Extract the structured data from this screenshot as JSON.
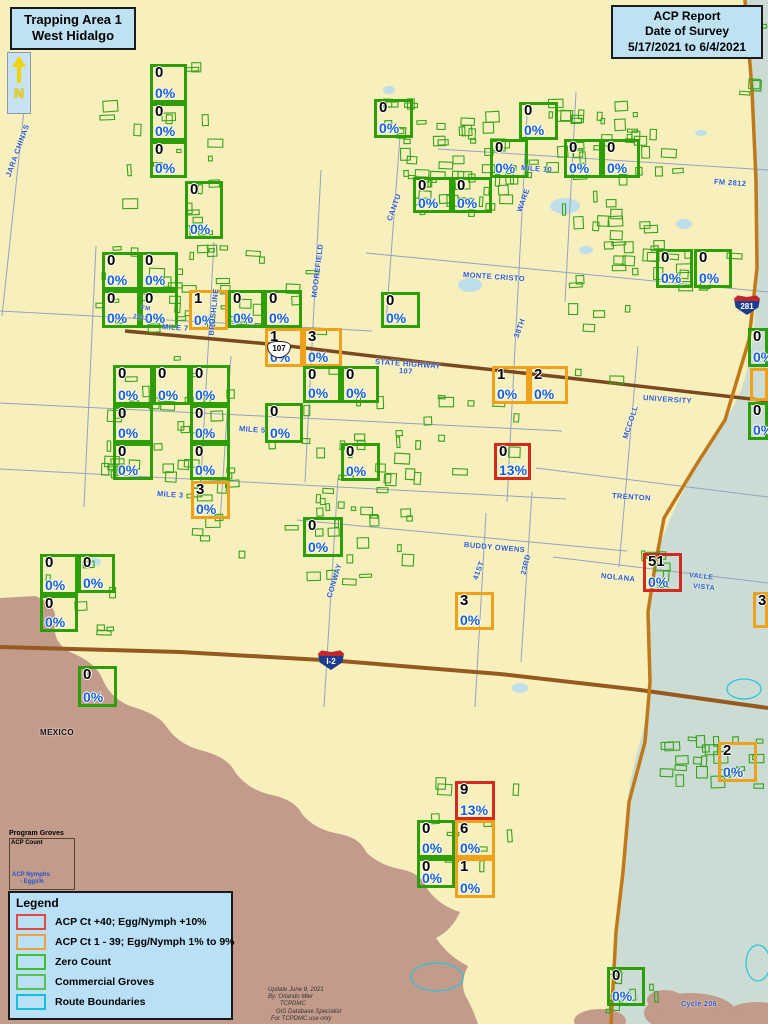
{
  "header": {
    "area_title_line1": "Trapping Area 1",
    "area_title_line2": "West Hidalgo",
    "report_line1": "ACP Report",
    "report_line2": "Date of Survey",
    "report_line3": "5/17/2021  to  6/4/2021",
    "compass_label": "N"
  },
  "legend": {
    "title": "Legend",
    "items": [
      {
        "label": "ACP Ct +40; Egg/Nymph +10%",
        "color": "#E04A3F"
      },
      {
        "label": "ACP Ct 1 - 39; Egg/Nymph 1% to 9%",
        "color": "#EDA33C"
      },
      {
        "label": "Zero Count",
        "color": "#3FBE2E"
      },
      {
        "label": "Commercial Groves",
        "color": "#55C14E"
      },
      {
        "label": "Route Boundaries",
        "color": "#17BEDC"
      }
    ]
  },
  "program_groves": {
    "title": "Program Groves",
    "line1": "ACP Count",
    "line2": "ACP  Nymphs",
    "line3": "- Eggs%"
  },
  "credits": {
    "lines": [
      "Update June 8, 2021",
      "By: Orlando Mier",
      "TCPDMC",
      "GIS Database Specialist",
      "For TCPDMC use only"
    ]
  },
  "colors": {
    "background": "#F7F0BD",
    "water": "#CADCD4",
    "foreign": "#C39B8B",
    "zero": "#2E9E08",
    "low": "#F0A11C",
    "high": "#D5291D",
    "grove": "#3AA21C",
    "pct_blue": "#155FD0",
    "label_blue": "#2E5BC6",
    "route": "#25C5DC",
    "pond": "#BEDFEA"
  },
  "trap_boxes": [
    [
      150,
      64,
      37,
      39,
      "0",
      "0%",
      "g"
    ],
    [
      150,
      103,
      37,
      38,
      "0",
      "0%",
      "g"
    ],
    [
      150,
      141,
      37,
      37,
      "0",
      "0%",
      "g"
    ],
    [
      185,
      181,
      38,
      58,
      "0",
      "0%",
      "g"
    ],
    [
      374,
      99,
      39,
      39,
      "0",
      "0%",
      "g"
    ],
    [
      519,
      102,
      39,
      38,
      "0",
      "0%",
      "g"
    ],
    [
      490,
      139,
      38,
      39,
      "0",
      "0%",
      "g"
    ],
    [
      564,
      139,
      38,
      39,
      "0",
      "0%",
      "g"
    ],
    [
      602,
      139,
      38,
      39,
      "0",
      "0%",
      "g"
    ],
    [
      413,
      177,
      39,
      36,
      "0",
      "0%",
      "g"
    ],
    [
      452,
      177,
      40,
      36,
      "0",
      "0%",
      "g"
    ],
    [
      102,
      252,
      38,
      38,
      "0",
      "0%",
      "g"
    ],
    [
      140,
      252,
      38,
      38,
      "0",
      "0%",
      "g"
    ],
    [
      102,
      290,
      38,
      38,
      "0",
      "0%",
      "g"
    ],
    [
      140,
      290,
      38,
      38,
      "0",
      "0%",
      "g"
    ],
    [
      189,
      290,
      39,
      40,
      "1",
      "0%",
      "o"
    ],
    [
      228,
      290,
      36,
      38,
      "0",
      "0%",
      "g"
    ],
    [
      264,
      290,
      38,
      38,
      "0",
      "0%",
      "g"
    ],
    [
      381,
      292,
      39,
      36,
      "0",
      "0%",
      "g"
    ],
    [
      656,
      249,
      37,
      39,
      "0",
      "0%",
      "g"
    ],
    [
      694,
      249,
      38,
      39,
      "0",
      "0%",
      "g"
    ],
    [
      265,
      328,
      38,
      39,
      "1",
      "0%",
      "o"
    ],
    [
      303,
      328,
      39,
      39,
      "3",
      "0%",
      "o"
    ],
    [
      113,
      365,
      40,
      40,
      "0",
      "0%",
      "g"
    ],
    [
      153,
      365,
      37,
      40,
      "0",
      "0%",
      "g"
    ],
    [
      190,
      365,
      40,
      40,
      "0",
      "0%",
      "g"
    ],
    [
      303,
      366,
      38,
      37,
      "0",
      "0%",
      "g"
    ],
    [
      341,
      366,
      38,
      37,
      "0",
      "0%",
      "g"
    ],
    [
      113,
      405,
      40,
      38,
      "0",
      "0%",
      "g"
    ],
    [
      190,
      405,
      40,
      38,
      "0",
      "0%",
      "g"
    ],
    [
      265,
      403,
      38,
      40,
      "0",
      "0%",
      "g"
    ],
    [
      113,
      443,
      40,
      37,
      "0",
      "0%",
      "g"
    ],
    [
      190,
      443,
      40,
      37,
      "0",
      "0%",
      "g"
    ],
    [
      341,
      443,
      39,
      38,
      "0",
      "0%",
      "g"
    ],
    [
      748,
      328,
      20,
      39,
      "0",
      "0%",
      "g"
    ],
    [
      750,
      368,
      18,
      33,
      "",
      "",
      "o"
    ],
    [
      748,
      402,
      20,
      38,
      "0",
      "0%",
      "g"
    ],
    [
      492,
      366,
      37,
      38,
      "1",
      "0%",
      "o"
    ],
    [
      529,
      366,
      39,
      38,
      "2",
      "0%",
      "o"
    ],
    [
      191,
      481,
      39,
      38,
      "3",
      "0%",
      "o"
    ],
    [
      494,
      443,
      37,
      37,
      "0",
      "13%",
      "r"
    ],
    [
      303,
      517,
      40,
      40,
      "0",
      "0%",
      "g"
    ],
    [
      643,
      553,
      39,
      39,
      "51",
      "0%",
      "r"
    ],
    [
      753,
      592,
      15,
      36,
      "3",
      "",
      "o"
    ],
    [
      455,
      592,
      39,
      38,
      "3",
      "0%",
      "o"
    ],
    [
      40,
      554,
      38,
      41,
      "0",
      "0%",
      "g"
    ],
    [
      78,
      554,
      37,
      39,
      "0",
      "0%",
      "g"
    ],
    [
      40,
      595,
      38,
      37,
      "0",
      "0%",
      "g"
    ],
    [
      78,
      666,
      39,
      41,
      "0",
      "0%",
      "g"
    ],
    [
      455,
      781,
      40,
      39,
      "9",
      "13%",
      "r"
    ],
    [
      417,
      820,
      38,
      38,
      "0",
      "0%",
      "g"
    ],
    [
      455,
      820,
      40,
      38,
      "6",
      "0%",
      "o"
    ],
    [
      417,
      858,
      38,
      30,
      "0",
      "0%",
      "g"
    ],
    [
      455,
      858,
      40,
      40,
      "1",
      "0%",
      "o"
    ],
    [
      718,
      742,
      39,
      40,
      "2",
      "0%",
      "o"
    ],
    [
      607,
      967,
      38,
      39,
      "0",
      "0%",
      "g"
    ]
  ],
  "road_labels": [
    [
      "JARA CHINAS",
      8,
      172,
      -70
    ],
    [
      "MILE 7",
      162,
      322,
      4
    ],
    [
      "FM",
      141,
      305,
      10,
      6
    ],
    [
      "2221",
      133,
      314,
      10,
      6
    ],
    [
      "BRUSHLINE",
      211,
      331,
      -84
    ],
    [
      "MOOREFIELD",
      314,
      293,
      -83
    ],
    [
      "CANTU",
      389,
      216,
      -70
    ],
    [
      "MILE 10",
      521,
      163,
      4
    ],
    [
      "WARE",
      519,
      207,
      -70
    ],
    [
      "MONTE CRISTO",
      463,
      270,
      4
    ],
    [
      "FM 2812",
      714,
      177,
      4
    ],
    [
      "STATE HIGHWAY",
      375,
      357,
      4
    ],
    [
      "107",
      399,
      366,
      4
    ],
    [
      "UNIVERSITY",
      643,
      393,
      4
    ],
    [
      "MCCOLL",
      625,
      434,
      -72
    ],
    [
      "38TH",
      516,
      333,
      -70
    ],
    [
      "TRENTON",
      612,
      491,
      4
    ],
    [
      "BUDDY OWENS",
      464,
      540,
      5
    ],
    [
      "MILE 5",
      239,
      424,
      4
    ],
    [
      "MILE 3",
      157,
      489,
      4
    ],
    [
      "CONWAY",
      329,
      593,
      -73
    ],
    [
      "41ST",
      475,
      575,
      -70
    ],
    [
      "23RD",
      523,
      570,
      -76
    ],
    [
      "NOLANA",
      601,
      571,
      6
    ],
    [
      "VALLE",
      689,
      572,
      6,
      7
    ],
    [
      "VISTA",
      693,
      583,
      6,
      7
    ],
    [
      "MEXICO",
      40,
      728,
      0,
      8,
      "#111111"
    ],
    [
      "Cycle 206",
      681,
      1001,
      0,
      7
    ]
  ],
  "shields": [
    {
      "t": "i",
      "label": "281",
      "x": 734,
      "y": 295
    },
    {
      "t": "i",
      "label": "I-2",
      "x": 318,
      "y": 650
    },
    {
      "t": "u",
      "label": "107",
      "x": 267,
      "y": 341
    }
  ],
  "map": {
    "areas": {
      "teal": "M745,0 L768,0 L768,1024 L611,1024 C616,930 624,870 627,810 C630,760 645,740 648,700 C651,655 647,610 655,566 C665,516 699,462 725,420 C748,388 757,340 756,268 C755,180 751,90 745,0 Z",
      "brown": "M0,598 L35,596 Q58,604 55,622 Q52,642 70,652 Q95,662 102,678 Q110,698 130,706 Q158,714 166,726 Q178,744 200,750 Q228,757 235,772 Q248,790 272,795 Q295,800 302,814 Q315,830 340,834 Q360,838 366,852 Q380,866 404,870 Q422,874 428,890 Q440,906 460,912 Q452,930 436,938 Q448,956 468,966 Q458,986 468,1000 Q474,1012 478,1024 L0,1024 Z",
      "brown_blobs": [
        [
          690,
          1013,
          46,
          20
        ],
        [
          757,
          1018,
          34,
          16
        ],
        [
          600,
          1021,
          26,
          12
        ],
        [
          665,
          1000,
          18,
          10
        ],
        [
          725,
          1022,
          20,
          10
        ]
      ]
    },
    "ponds": [
      [
        565,
        206,
        15,
        8
      ],
      [
        470,
        285,
        12,
        7
      ],
      [
        520,
        688,
        8,
        5
      ],
      [
        94,
        562,
        7,
        4
      ],
      [
        389,
        90,
        6,
        4
      ],
      [
        684,
        224,
        8,
        5
      ],
      [
        701,
        133,
        6,
        3
      ],
      [
        586,
        250,
        7,
        4
      ]
    ],
    "cyan": [
      [
        437,
        977,
        26,
        14
      ],
      [
        744,
        689,
        17,
        10
      ],
      [
        758,
        963,
        12,
        18
      ]
    ],
    "roads_thin": [
      [
        30,
        54,
        2,
        316
      ],
      [
        0,
        311,
        372,
        331
      ],
      [
        214,
        242,
        200,
        497
      ],
      [
        321,
        170,
        305,
        482
      ],
      [
        400,
        136,
        386,
        322
      ],
      [
        527,
        116,
        507,
        502
      ],
      [
        338,
        478,
        324,
        707
      ],
      [
        486,
        513,
        475,
        707
      ],
      [
        532,
        492,
        521,
        662
      ],
      [
        638,
        346,
        619,
        567
      ],
      [
        438,
        149,
        768,
        170
      ],
      [
        366,
        253,
        768,
        292
      ],
      [
        0,
        403,
        562,
        431
      ],
      [
        0,
        469,
        566,
        499
      ],
      [
        536,
        468,
        768,
        497
      ],
      [
        297,
        520,
        627,
        551
      ],
      [
        553,
        557,
        768,
        583
      ],
      [
        96,
        246,
        84,
        507
      ],
      [
        231,
        356,
        220,
        522
      ],
      [
        576,
        92,
        565,
        302
      ]
    ],
    "roads_major": [
      {
        "pts": [
          [
            125,
            331
          ],
          [
            280,
            345
          ],
          [
            430,
            363
          ],
          [
            560,
            377
          ],
          [
            768,
            401
          ]
        ],
        "c": "#7A4A1E",
        "w": 3.5
      },
      {
        "pts": [
          [
            0,
            647
          ],
          [
            180,
            652
          ],
          [
            340,
            661
          ],
          [
            500,
            674
          ],
          [
            640,
            690
          ],
          [
            768,
            708
          ]
        ],
        "c": "#96591F",
        "w": 4
      },
      {
        "pts": [
          [
            745,
            0
          ],
          [
            752,
            90
          ],
          [
            756,
            180
          ],
          [
            757,
            268
          ],
          [
            749,
            340
          ],
          [
            725,
            420
          ],
          [
            698,
            462
          ],
          [
            664,
            518
          ],
          [
            655,
            566
          ],
          [
            648,
            612
          ],
          [
            650,
            682
          ],
          [
            645,
            742
          ],
          [
            629,
            802
          ],
          [
            623,
            872
          ],
          [
            616,
            932
          ],
          [
            611,
            1024
          ]
        ],
        "c": "#C07818",
        "w": 3.5
      }
    ],
    "grove_clusters": [
      [
        150,
        62,
        78,
        185,
        16
      ],
      [
        372,
        96,
        46,
        42,
        7
      ],
      [
        398,
        108,
        135,
        110,
        48
      ],
      [
        520,
        95,
        118,
        88,
        20
      ],
      [
        556,
        128,
        108,
        158,
        24
      ],
      [
        610,
        212,
        62,
        58,
        7
      ],
      [
        652,
        240,
        92,
        55,
        9
      ],
      [
        95,
        240,
        138,
        92,
        26
      ],
      [
        232,
        252,
        100,
        85,
        11
      ],
      [
        95,
        355,
        142,
        128,
        30
      ],
      [
        295,
        360,
        132,
        162,
        18
      ],
      [
        420,
        378,
        118,
        108,
        9
      ],
      [
        186,
        476,
        64,
        92,
        11
      ],
      [
        300,
        478,
        122,
        108,
        16
      ],
      [
        640,
        548,
        48,
        48,
        7
      ],
      [
        658,
        732,
        106,
        58,
        24
      ],
      [
        602,
        958,
        58,
        56,
        9
      ],
      [
        415,
        778,
        112,
        118,
        10
      ],
      [
        33,
        548,
        92,
        88,
        7
      ],
      [
        338,
        438,
        48,
        46,
        5
      ],
      [
        728,
        12,
        44,
        34,
        4
      ],
      [
        736,
        76,
        30,
        28,
        3
      ],
      [
        252,
        420,
        205,
        145,
        7
      ],
      [
        610,
        120,
        80,
        60,
        6
      ],
      [
        540,
        300,
        120,
        100,
        6
      ],
      [
        100,
        95,
        40,
        120,
        5
      ]
    ]
  }
}
